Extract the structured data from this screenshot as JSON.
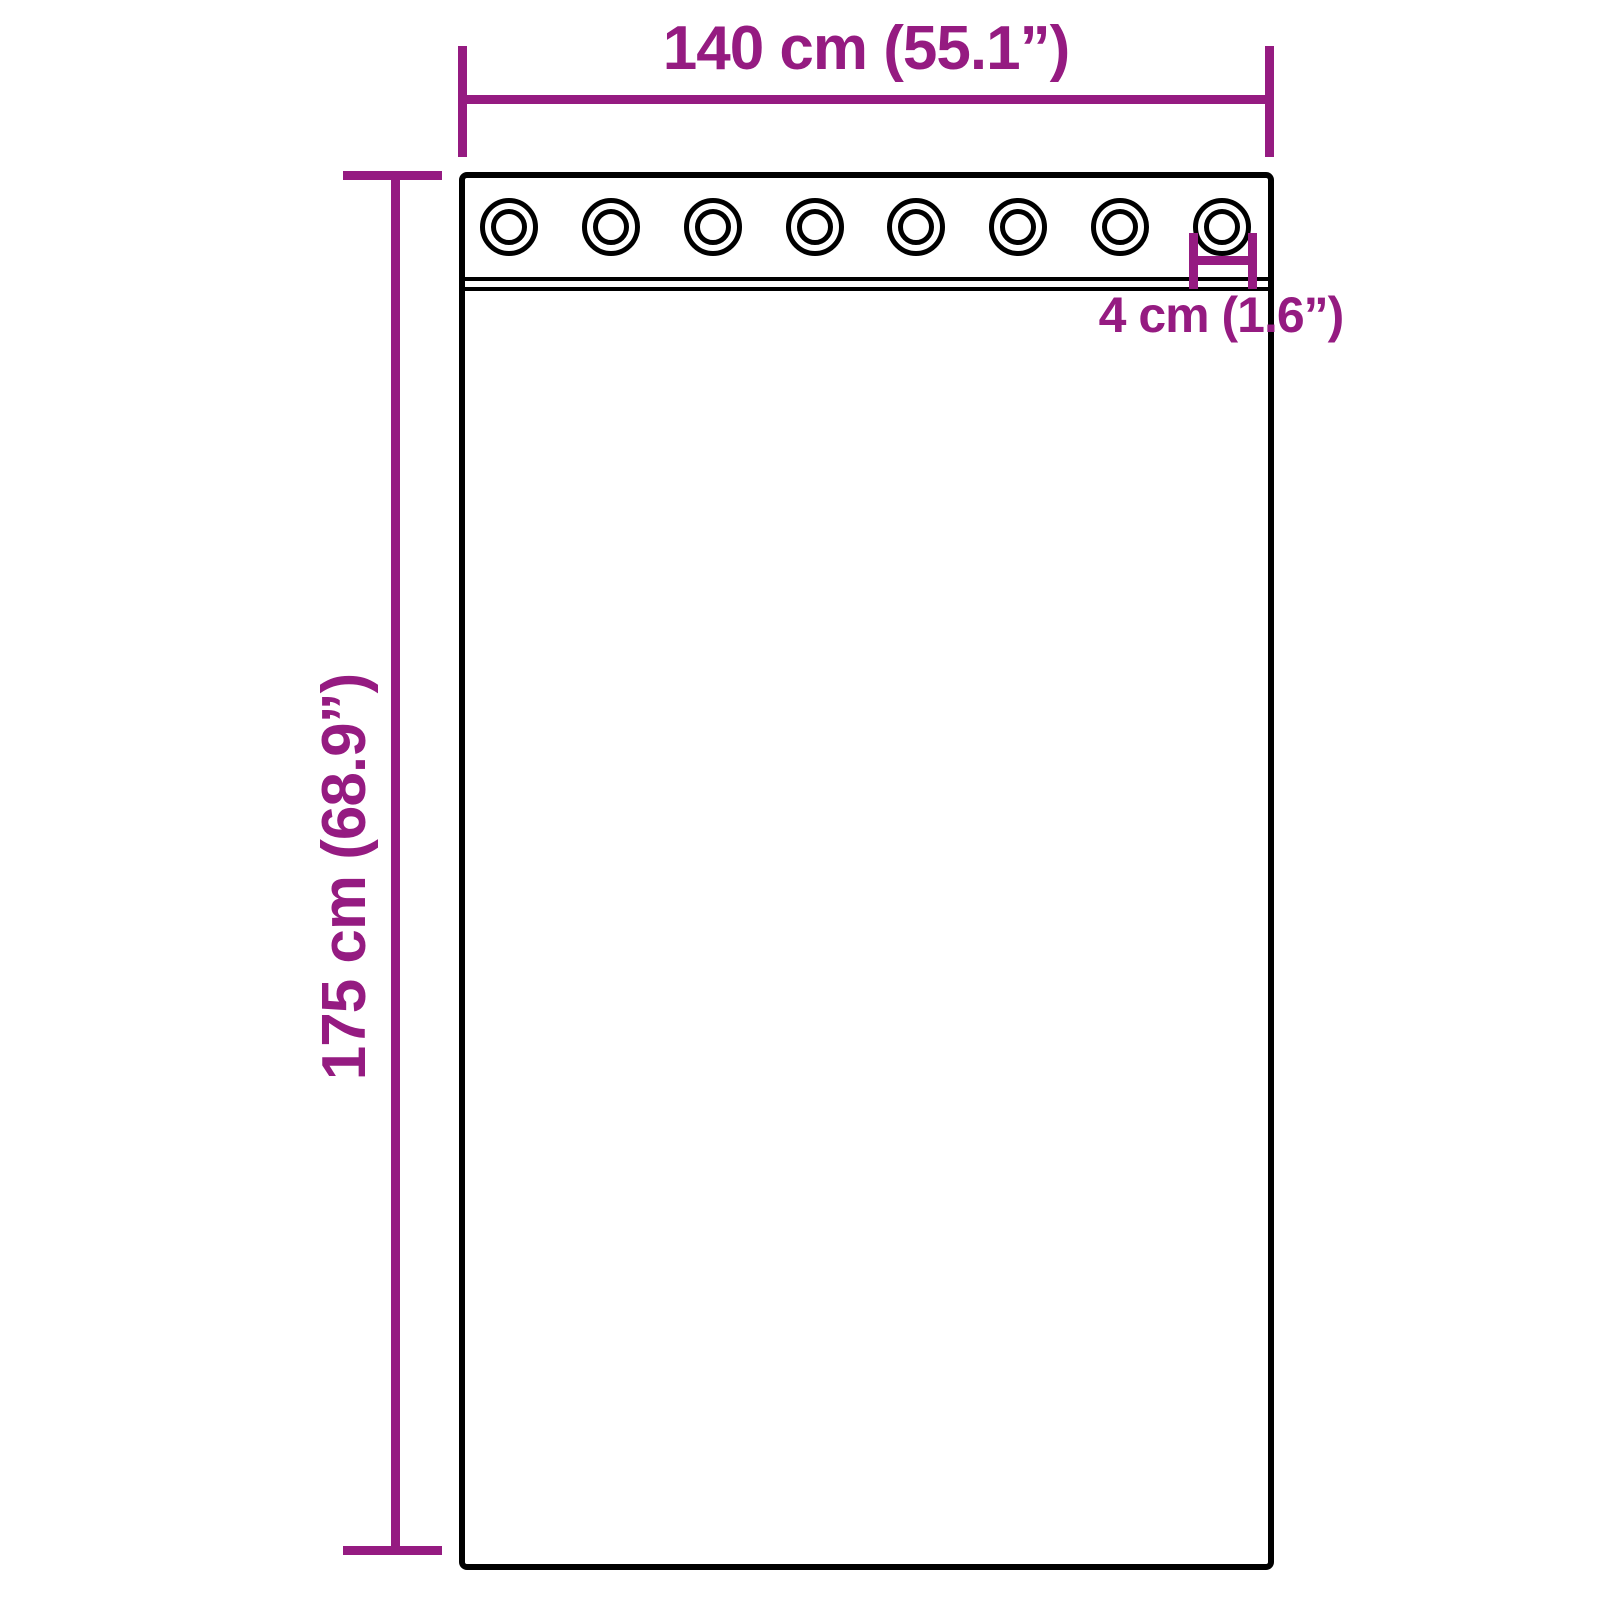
{
  "diagram": {
    "type": "product-dimension-diagram",
    "subject": "grommet-curtain-panel",
    "background_color": "#ffffff",
    "accent_color": "#951b81",
    "outline_color": "#000000",
    "grommet_count": 8,
    "dimensions": {
      "width_label": "140 cm (55.1”)",
      "height_label": "175 cm (68.9”)",
      "grommet_label": "4 cm (1.6”)"
    }
  }
}
